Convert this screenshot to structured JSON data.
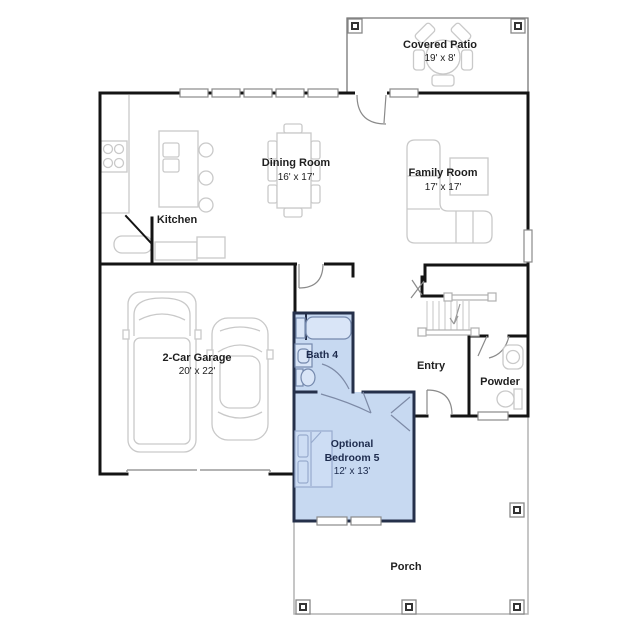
{
  "plan": {
    "rooms": {
      "covered_patio": {
        "name": "Covered Patio",
        "dims": "19' x 8'"
      },
      "dining_room": {
        "name": "Dining Room",
        "dims": "16' x 17'"
      },
      "family_room": {
        "name": "Family Room",
        "dims": "17' x 17'"
      },
      "kitchen": {
        "name": "Kitchen"
      },
      "garage": {
        "name": "2-Car Garage",
        "dims": "20' x 22'"
      },
      "bath4": {
        "name": "Bath 4"
      },
      "entry": {
        "name": "Entry"
      },
      "powder": {
        "name": "Powder"
      },
      "bedroom5": {
        "line1": "Optional",
        "line2": "Bedroom 5",
        "dims": "12' x 13'"
      },
      "porch": {
        "name": "Porch"
      }
    },
    "colors": {
      "highlight_fill": "#c7d9f1",
      "highlight_wall": "#25304a",
      "wall": "#141414",
      "furniture_line": "#c9c9c9",
      "label_text": "#1f1f1f",
      "highlight_text": "#1d2b4d"
    }
  }
}
